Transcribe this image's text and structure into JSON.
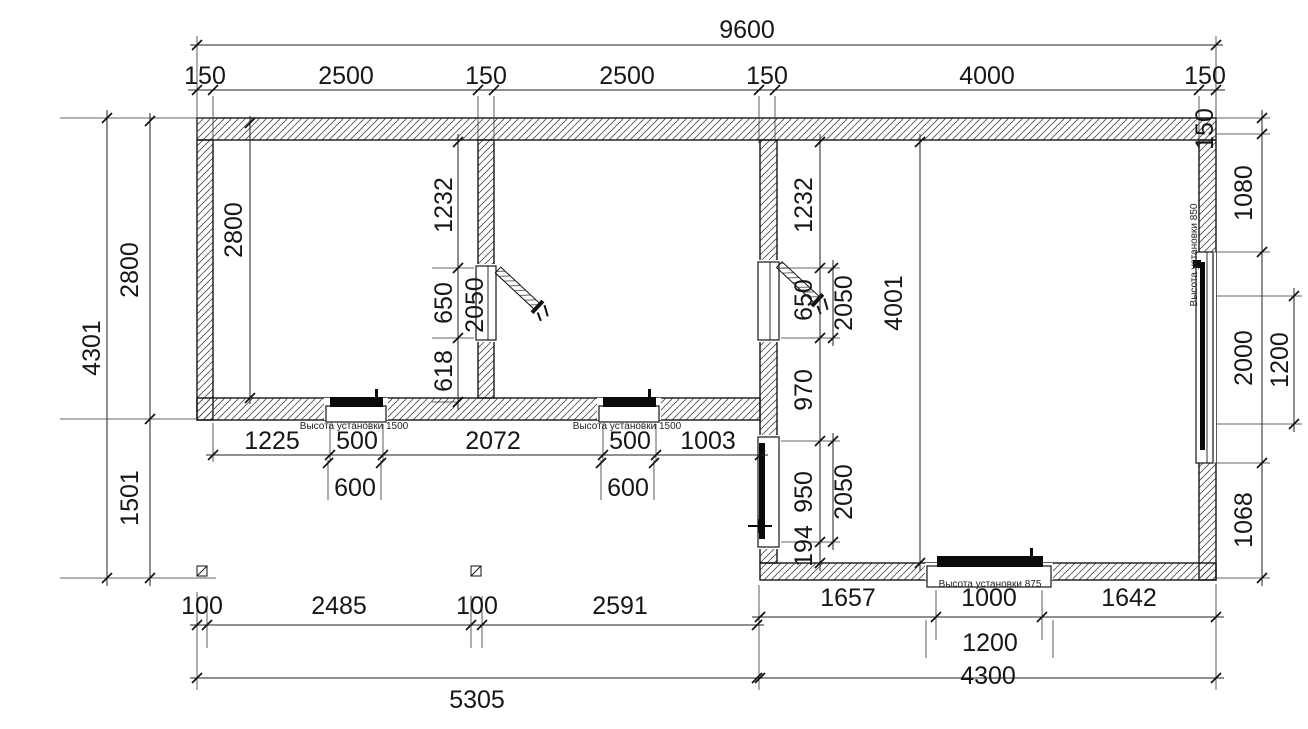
{
  "dims": {
    "overall_width": "9600",
    "top_row": [
      "150",
      "2500",
      "150",
      "2500",
      "150",
      "4000",
      "150"
    ],
    "left_overall": "4301",
    "left_upper": "2800",
    "left_lower": "1501",
    "room1_depth": "2800",
    "wall12": {
      "upper": "1232",
      "opening": "650",
      "lower": "618",
      "opening_height": "2050"
    },
    "under_rooms": [
      "1225",
      "500",
      "2072",
      "500",
      "1003"
    ],
    "device1_frame": "600",
    "device2_frame": "600",
    "columns_row": [
      "100",
      "2485",
      "100",
      "2591"
    ],
    "left_total": "5305",
    "wall23": {
      "upper": "1232",
      "opening": "650",
      "opening_height": "2050",
      "mid": "970",
      "door": "950",
      "door_height": "2050",
      "lower": "194"
    },
    "room3_depth": "4001",
    "right_wall": {
      "thickness": "150",
      "upper": "1080",
      "window": "2000",
      "glass": "1200",
      "lower": "1068"
    },
    "bottom_row": [
      "1657",
      "1000",
      "1642"
    ],
    "device3_frame": "1200",
    "right_total": "4300"
  },
  "labels": {
    "install_room1": "Высота установки 1500",
    "install_room2": "Высота установки 1500",
    "install_room3_bottom": "Высота установки 875",
    "install_room3_right": "Высота установки 850"
  }
}
